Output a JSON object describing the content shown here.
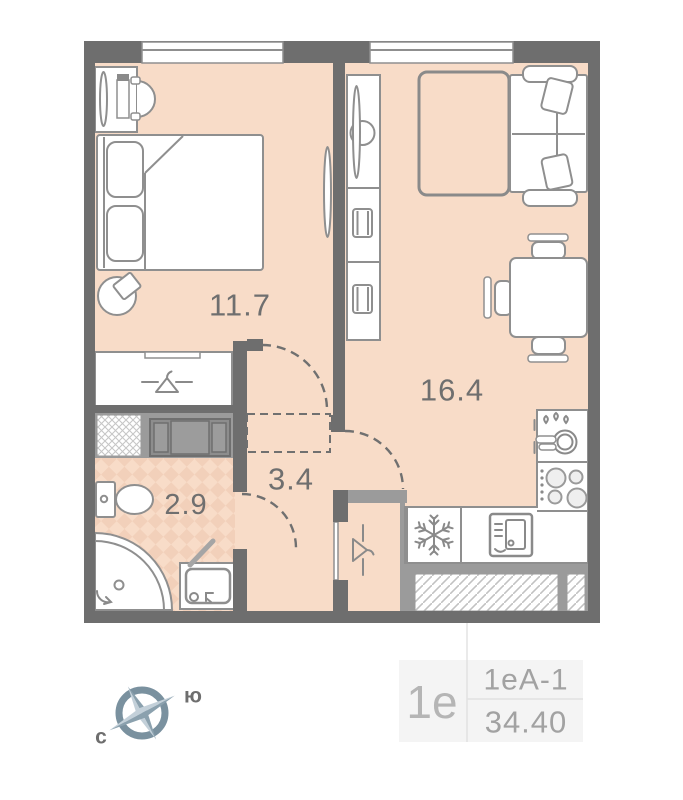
{
  "plan": {
    "rooms": [
      {
        "id": "bedroom",
        "area_label": "11.7"
      },
      {
        "id": "living-kitchen",
        "area_label": "16.4"
      },
      {
        "id": "hallway",
        "area_label": "3.4"
      },
      {
        "id": "bathroom",
        "area_label": "2.9"
      }
    ]
  },
  "compass": {
    "north_label": "с",
    "south_label": "ю"
  },
  "info": {
    "plan_type": "1е",
    "layout_code": "1еА-1",
    "total_area": "34.40"
  },
  "icons": {
    "fridge": "snowflake-icon",
    "bedroom_wardrobe": "hanger-icon",
    "hall_closet": "hanger-icon",
    "kitchen_sink": "dishes-icon",
    "stove": "burners-icon",
    "compass": "compass-rose-icon"
  },
  "colors": {
    "wall": "#6e6e6e",
    "floor": "#f8dcc8",
    "floor_accent": "#f2d0ba",
    "furniture_stroke": "#8f8f8f",
    "counter_gray": "#9b9b9b",
    "label_text": "#6f6f6f",
    "info_text": "#a2a2a2",
    "info_bg": "#f4f4f4",
    "compass_ring": "#7a919f",
    "compass_blade_light": "#c3d0d9",
    "compass_blade_dark": "#8ba1ae"
  }
}
